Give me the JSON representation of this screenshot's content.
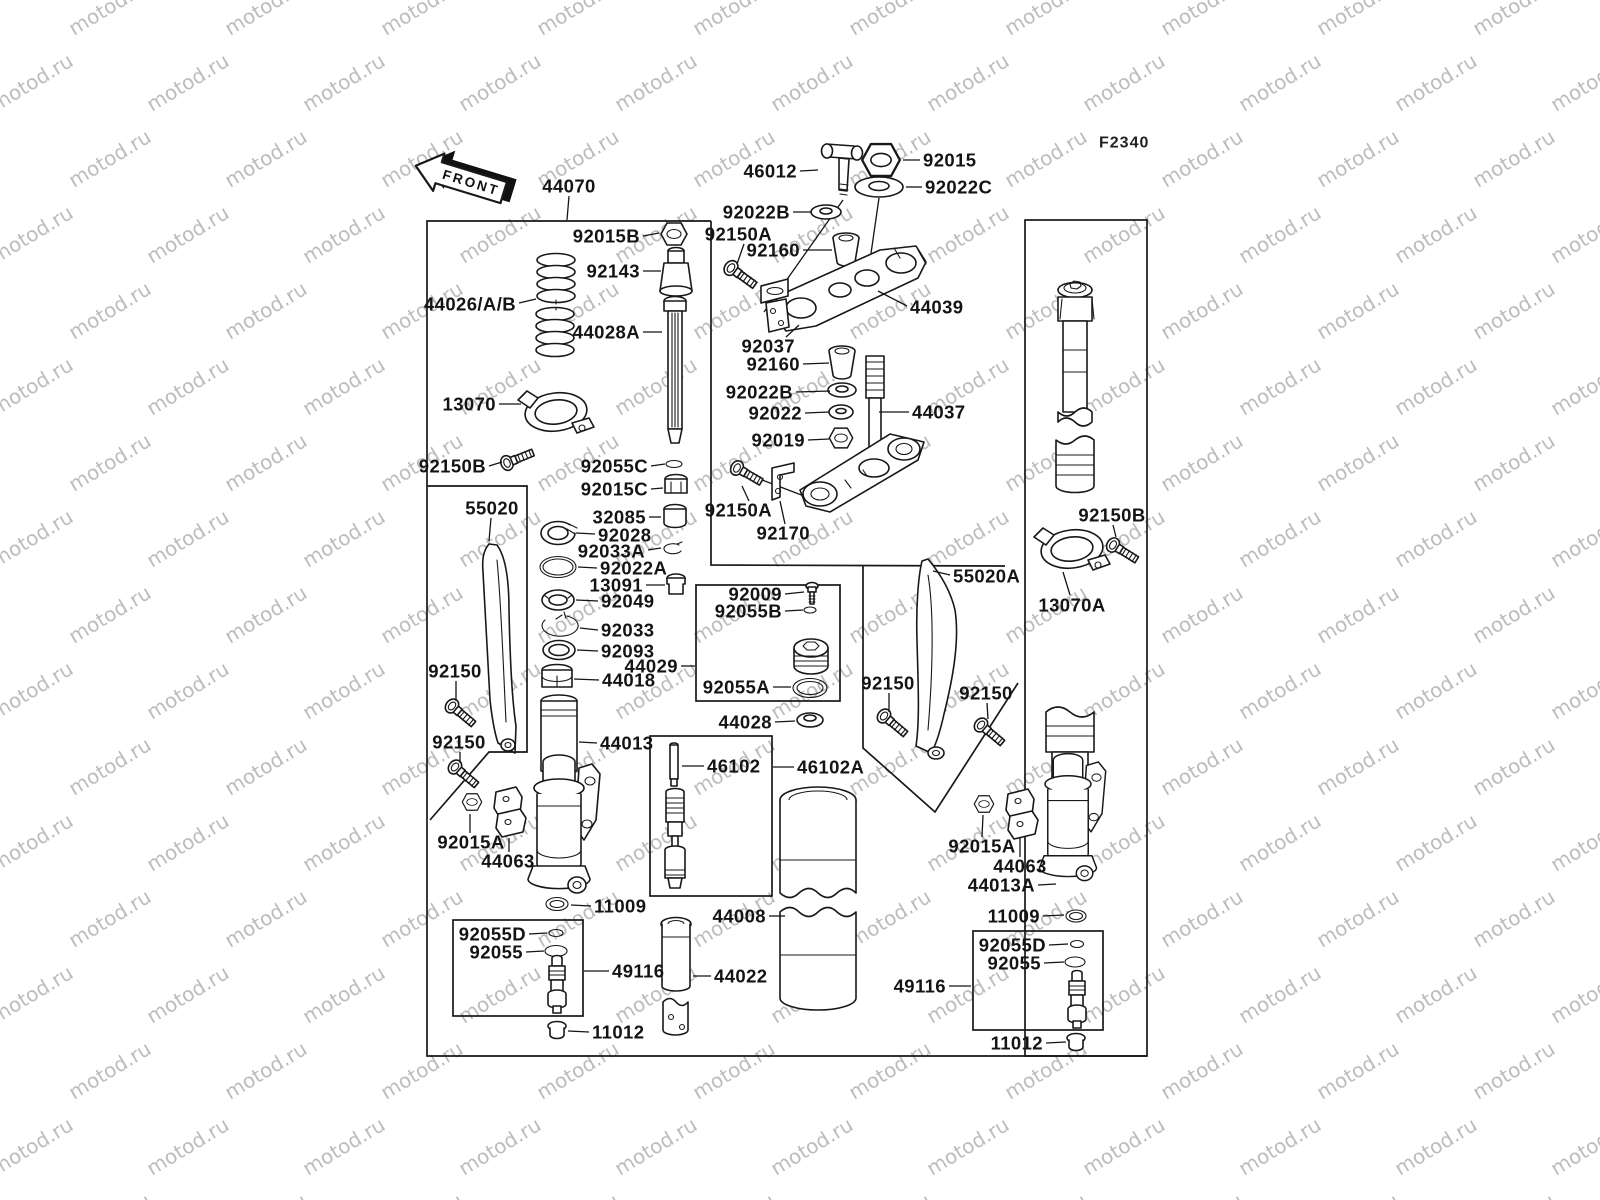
{
  "diagram": {
    "code": "F2340",
    "front_label": "FRONT",
    "watermark_text": "motod.ru",
    "colors": {
      "line": "#181818",
      "watermark": "#bcbcbc",
      "background": "#ffffff"
    },
    "labels": [
      {
        "t": "46012",
        "x": 797,
        "y": 171,
        "a": "e",
        "l": [
          [
            800,
            171
          ],
          [
            818,
            170
          ]
        ]
      },
      {
        "t": "92015",
        "x": 923,
        "y": 160,
        "a": "s",
        "l": [
          [
            920,
            160
          ],
          [
            903,
            160
          ]
        ]
      },
      {
        "t": "92022C",
        "x": 925,
        "y": 187,
        "a": "s",
        "l": [
          [
            922,
            187
          ],
          [
            906,
            187
          ]
        ]
      },
      {
        "t": "92022B",
        "x": 790,
        "y": 212,
        "a": "e",
        "l": [
          [
            793,
            212
          ],
          [
            812,
            212
          ]
        ]
      },
      {
        "t": "92150A",
        "x": 772,
        "y": 234,
        "a": "e",
        "l": [
          [
            744,
            244
          ],
          [
            737,
            264
          ]
        ]
      },
      {
        "t": "92160",
        "x": 800,
        "y": 250,
        "a": "e",
        "l": [
          [
            803,
            250
          ],
          [
            832,
            250
          ]
        ]
      },
      {
        "t": "44039",
        "x": 910,
        "y": 307,
        "a": "s",
        "l": [
          [
            907,
            306
          ],
          [
            878,
            291
          ]
        ]
      },
      {
        "t": "92037",
        "x": 795,
        "y": 346,
        "a": "e",
        "l": [
          [
            786,
            337
          ],
          [
            799,
            325
          ]
        ]
      },
      {
        "t": "92160",
        "x": 800,
        "y": 364,
        "a": "e",
        "l": [
          [
            803,
            364
          ],
          [
            829,
            363
          ]
        ]
      },
      {
        "t": "92022B",
        "x": 793,
        "y": 392,
        "a": "e",
        "l": [
          [
            796,
            392
          ],
          [
            830,
            391
          ]
        ]
      },
      {
        "t": "92022",
        "x": 802,
        "y": 413,
        "a": "e",
        "l": [
          [
            805,
            413
          ],
          [
            829,
            412
          ]
        ]
      },
      {
        "t": "92019",
        "x": 805,
        "y": 440,
        "a": "e",
        "l": [
          [
            808,
            440
          ],
          [
            829,
            439
          ]
        ]
      },
      {
        "t": "44037",
        "x": 912,
        "y": 412,
        "a": "s",
        "l": [
          [
            909,
            412
          ],
          [
            879,
            412
          ]
        ]
      },
      {
        "t": "92150A",
        "x": 772,
        "y": 510,
        "a": "e",
        "l": [
          [
            749,
            501
          ],
          [
            742,
            486
          ]
        ]
      },
      {
        "t": "92170",
        "x": 810,
        "y": 533,
        "a": "e",
        "l": [
          [
            785,
            524
          ],
          [
            780,
            501
          ]
        ]
      },
      {
        "t": "44070",
        "x": 569,
        "y": 186,
        "a": "m",
        "l": [
          [
            569,
            196
          ],
          [
            567,
            220
          ]
        ]
      },
      {
        "t": "92015B",
        "x": 640,
        "y": 236,
        "a": "e",
        "l": [
          [
            643,
            236
          ],
          [
            659,
            233
          ]
        ]
      },
      {
        "t": "92143",
        "x": 640,
        "y": 271,
        "a": "e",
        "l": [
          [
            643,
            271
          ],
          [
            661,
            271
          ]
        ]
      },
      {
        "t": "44026/A/B",
        "x": 516,
        "y": 304,
        "a": "e",
        "l": [
          [
            519,
            303
          ],
          [
            536,
            299
          ]
        ]
      },
      {
        "t": "44028A",
        "x": 640,
        "y": 332,
        "a": "e",
        "l": [
          [
            643,
            332
          ],
          [
            662,
            332
          ]
        ]
      },
      {
        "t": "13070",
        "x": 496,
        "y": 404,
        "a": "e",
        "l": [
          [
            499,
            404
          ],
          [
            521,
            404
          ]
        ]
      },
      {
        "t": "92150B",
        "x": 486,
        "y": 466,
        "a": "e",
        "l": [
          [
            489,
            466
          ],
          [
            502,
            462
          ]
        ]
      },
      {
        "t": "55020",
        "x": 492,
        "y": 508,
        "a": "m",
        "l": [
          [
            491,
            518
          ],
          [
            489,
            541
          ]
        ]
      },
      {
        "t": "92055C",
        "x": 648,
        "y": 466,
        "a": "e",
        "l": [
          [
            651,
            466
          ],
          [
            665,
            464
          ]
        ]
      },
      {
        "t": "92015C",
        "x": 648,
        "y": 489,
        "a": "e",
        "l": [
          [
            651,
            489
          ],
          [
            663,
            488
          ]
        ]
      },
      {
        "t": "32085",
        "x": 646,
        "y": 517,
        "a": "e",
        "l": [
          [
            649,
            517
          ],
          [
            661,
            517
          ]
        ]
      },
      {
        "t": "92028",
        "x": 598,
        "y": 535,
        "a": "s",
        "l": [
          [
            595,
            534
          ],
          [
            576,
            533
          ]
        ]
      },
      {
        "t": "92033A",
        "x": 645,
        "y": 551,
        "a": "e",
        "l": [
          [
            648,
            550
          ],
          [
            661,
            548
          ]
        ]
      },
      {
        "t": "92022A",
        "x": 600,
        "y": 568,
        "a": "s",
        "l": [
          [
            597,
            568
          ],
          [
            578,
            567
          ]
        ]
      },
      {
        "t": "13091",
        "x": 643,
        "y": 585,
        "a": "e",
        "l": [
          [
            646,
            585
          ],
          [
            665,
            585
          ]
        ]
      },
      {
        "t": "92049",
        "x": 601,
        "y": 601,
        "a": "s",
        "l": [
          [
            598,
            601
          ],
          [
            576,
            600
          ]
        ]
      },
      {
        "t": "92033",
        "x": 601,
        "y": 630,
        "a": "s",
        "l": [
          [
            598,
            630
          ],
          [
            580,
            628
          ]
        ]
      },
      {
        "t": "92093",
        "x": 601,
        "y": 651,
        "a": "s",
        "l": [
          [
            598,
            651
          ],
          [
            577,
            650
          ]
        ]
      },
      {
        "t": "44029",
        "x": 678,
        "y": 666,
        "a": "e",
        "l": [
          [
            681,
            666
          ],
          [
            695,
            666
          ]
        ]
      },
      {
        "t": "44018",
        "x": 602,
        "y": 680,
        "a": "s",
        "l": [
          [
            599,
            680
          ],
          [
            574,
            679
          ]
        ]
      },
      {
        "t": "44013",
        "x": 600,
        "y": 743,
        "a": "s",
        "l": [
          [
            597,
            743
          ],
          [
            579,
            742
          ]
        ]
      },
      {
        "t": "92009",
        "x": 782,
        "y": 594,
        "a": "e",
        "l": [
          [
            785,
            594
          ],
          [
            804,
            592
          ]
        ]
      },
      {
        "t": "92055B",
        "x": 782,
        "y": 611,
        "a": "e",
        "l": [
          [
            785,
            611
          ],
          [
            803,
            610
          ]
        ]
      },
      {
        "t": "92055A",
        "x": 770,
        "y": 687,
        "a": "e",
        "l": [
          [
            773,
            687
          ],
          [
            791,
            687
          ]
        ]
      },
      {
        "t": "44028",
        "x": 772,
        "y": 722,
        "a": "e",
        "l": [
          [
            775,
            722
          ],
          [
            795,
            721
          ]
        ]
      },
      {
        "t": "46102",
        "x": 707,
        "y": 766,
        "a": "s",
        "l": [
          [
            704,
            766
          ],
          [
            682,
            766
          ]
        ]
      },
      {
        "t": "46102A",
        "x": 797,
        "y": 767,
        "a": "s",
        "l": [
          [
            794,
            767
          ],
          [
            773,
            767
          ]
        ]
      },
      {
        "t": "11009",
        "x": 594,
        "y": 906,
        "a": "s",
        "l": [
          [
            591,
            906
          ],
          [
            571,
            905
          ]
        ]
      },
      {
        "t": "92055D",
        "x": 526,
        "y": 934,
        "a": "e",
        "l": [
          [
            529,
            934
          ],
          [
            547,
            933
          ]
        ]
      },
      {
        "t": "92055",
        "x": 523,
        "y": 952,
        "a": "e",
        "l": [
          [
            526,
            952
          ],
          [
            544,
            951
          ]
        ]
      },
      {
        "t": "49116",
        "x": 612,
        "y": 971,
        "a": "s",
        "l": [
          [
            609,
            971
          ],
          [
            584,
            971
          ]
        ]
      },
      {
        "t": "11012",
        "x": 592,
        "y": 1032,
        "a": "s",
        "l": [
          [
            589,
            1032
          ],
          [
            568,
            1031
          ]
        ]
      },
      {
        "t": "44008",
        "x": 766,
        "y": 916,
        "a": "e",
        "l": [
          [
            769,
            916
          ],
          [
            785,
            916
          ]
        ]
      },
      {
        "t": "44022",
        "x": 714,
        "y": 976,
        "a": "s",
        "l": [
          [
            711,
            976
          ],
          [
            693,
            976
          ]
        ]
      },
      {
        "t": "92015A",
        "x": 471,
        "y": 842,
        "a": "m",
        "l": [
          [
            470,
            833
          ],
          [
            470,
            814
          ]
        ]
      },
      {
        "t": "44063",
        "x": 508,
        "y": 861,
        "a": "m",
        "l": [
          [
            509,
            852
          ],
          [
            509,
            838
          ]
        ]
      },
      {
        "t": "92150",
        "x": 455,
        "y": 671,
        "a": "m",
        "l": [
          [
            456,
            681
          ],
          [
            456,
            701
          ]
        ]
      },
      {
        "t": "92150",
        "x": 459,
        "y": 742,
        "a": "m",
        "l": [
          [
            460,
            752
          ],
          [
            460,
            763
          ]
        ]
      },
      {
        "t": "55020A",
        "x": 953,
        "y": 576,
        "a": "s",
        "l": [
          [
            950,
            575
          ],
          [
            933,
            571
          ]
        ]
      },
      {
        "t": "13070A",
        "x": 1072,
        "y": 605,
        "a": "m",
        "l": [
          [
            1070,
            595
          ],
          [
            1063,
            572
          ]
        ]
      },
      {
        "t": "92150B",
        "x": 1112,
        "y": 515,
        "a": "m",
        "l": [
          [
            1113,
            525
          ],
          [
            1116,
            537
          ]
        ]
      },
      {
        "t": "92150",
        "x": 888,
        "y": 683,
        "a": "m",
        "l": [
          [
            889,
            693
          ],
          [
            889,
            712
          ]
        ]
      },
      {
        "t": "92150",
        "x": 986,
        "y": 693,
        "a": "m",
        "l": [
          [
            987,
            703
          ],
          [
            988,
            719
          ]
        ]
      },
      {
        "t": "92015A",
        "x": 982,
        "y": 846,
        "a": "m",
        "l": [
          [
            982,
            837
          ],
          [
            983,
            815
          ]
        ]
      },
      {
        "t": "44063",
        "x": 1020,
        "y": 866,
        "a": "m",
        "l": [
          [
            1020,
            857
          ],
          [
            1020,
            837
          ]
        ]
      },
      {
        "t": "44013A",
        "x": 1035,
        "y": 885,
        "a": "e",
        "l": [
          [
            1038,
            885
          ],
          [
            1056,
            884
          ]
        ]
      },
      {
        "t": "11009",
        "x": 1040,
        "y": 916,
        "a": "e",
        "l": [
          [
            1043,
            916
          ],
          [
            1064,
            915
          ]
        ]
      },
      {
        "t": "92055D",
        "x": 1046,
        "y": 945,
        "a": "e",
        "l": [
          [
            1049,
            945
          ],
          [
            1068,
            944
          ]
        ]
      },
      {
        "t": "92055",
        "x": 1041,
        "y": 963,
        "a": "e",
        "l": [
          [
            1044,
            963
          ],
          [
            1064,
            962
          ]
        ]
      },
      {
        "t": "49116",
        "x": 946,
        "y": 986,
        "a": "e",
        "l": [
          [
            949,
            986
          ],
          [
            971,
            986
          ]
        ]
      },
      {
        "t": "11012",
        "x": 1043,
        "y": 1043,
        "a": "e",
        "l": [
          [
            1046,
            1043
          ],
          [
            1066,
            1042
          ]
        ]
      }
    ]
  }
}
